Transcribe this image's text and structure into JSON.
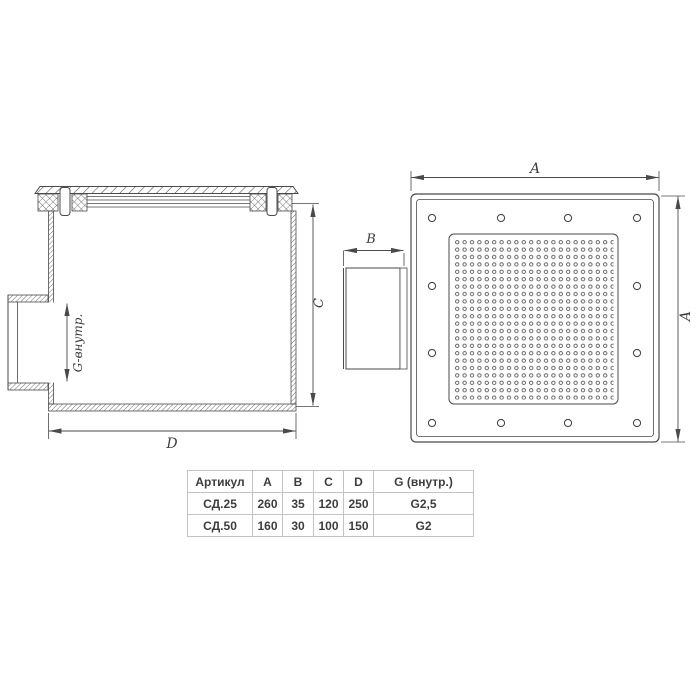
{
  "drawing": {
    "side_view": {
      "g_dim_label": "G-внутр.",
      "c_dim_label": "C",
      "d_dim_label": "D"
    },
    "front_view": {
      "a_top_dim_label": "A",
      "a_right_dim_label": "A",
      "b_dim_label": "B"
    }
  },
  "table": {
    "headers": [
      "Артикул",
      "A",
      "B",
      "C",
      "D",
      "G (внутр.)"
    ],
    "rows": [
      [
        "СД.25",
        "260",
        "35",
        "120",
        "250",
        "G2,5"
      ],
      [
        "СД.50",
        "160",
        "30",
        "100",
        "150",
        "G2"
      ]
    ]
  },
  "colors": {
    "line": "#4a4a4a",
    "table_border": "#c3c3c3",
    "text": "#3d3d3d",
    "background": "#ffffff"
  }
}
